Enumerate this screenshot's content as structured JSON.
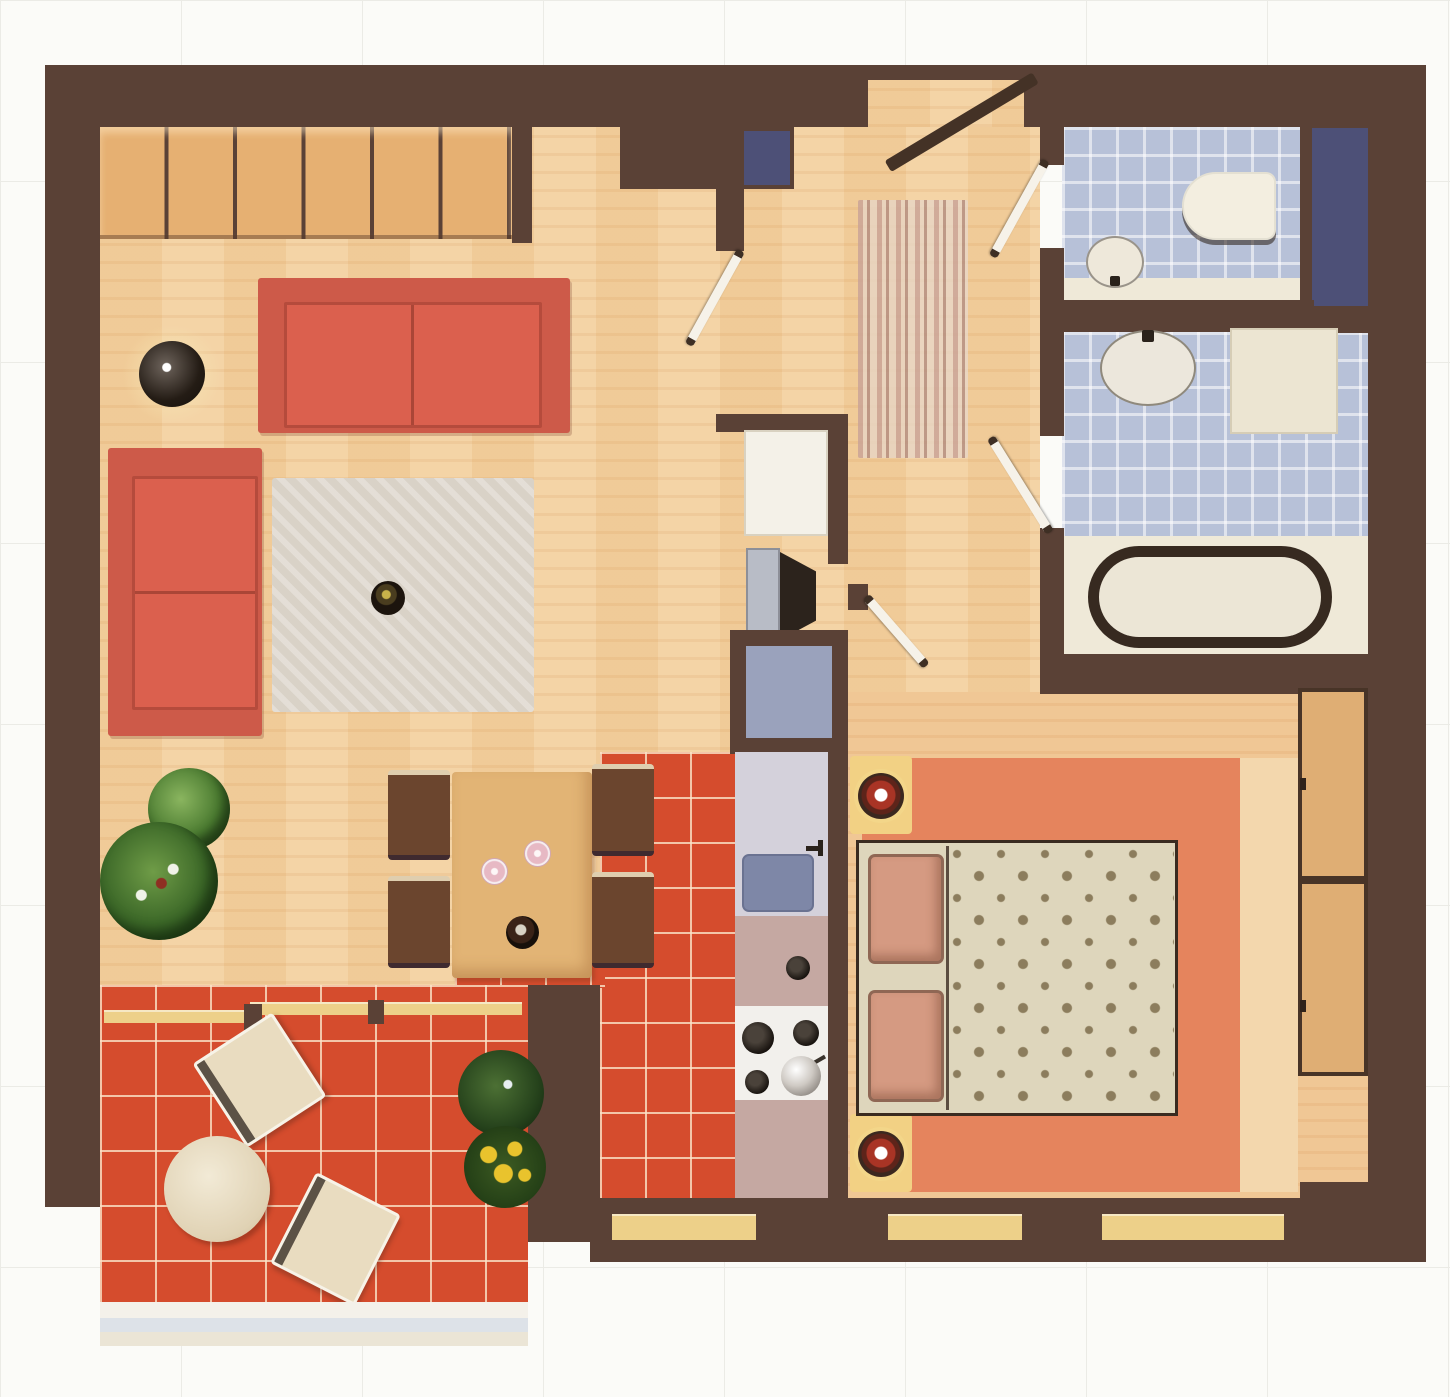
{
  "meta": {
    "kind": "apartment-floor-plan",
    "view": "top-down-3d-render",
    "text_labels": []
  },
  "palette": {
    "page_bg": "#fbfbf8",
    "grid_line": "#ebebe6",
    "wall": "#5a4136",
    "wood": "#f2cf9e",
    "wood_bedroom": "#f0c795",
    "closet": "#e6b072",
    "sofa_red": "#cd5a49",
    "rug_gray": "#d9d2c7",
    "tile_red": "#d54c2d",
    "blue_tile": "#b7c1d8",
    "navy": "#4d5077",
    "cream": "#efe9d8",
    "tub_line": "#372a20",
    "bedroom_rug": "#e5845d",
    "rug_border": "#f3d7ad",
    "bed_frame": "#f2d184",
    "lamp_red": "#a93425",
    "pillow": "#d59a82",
    "duvet": "#ded6bc",
    "duvet_dot": "#8c7d5d",
    "wardrobe": "#dfae74",
    "chair_brown": "#6b452e",
    "chair_cream": "#e9dcc0",
    "table_wood": "#e2b475",
    "counter": "#c5a8a2",
    "counter_light": "#d4d1db",
    "sink_blue": "#7e87a7",
    "cooktop": "#f2f0ec",
    "runner_a": "#c8a197",
    "runner_b": "#e7d5c5",
    "plant_green": "#49792f",
    "plant_dark": "#27491d",
    "flower_yellow": "#e9c32d",
    "door_white": "#f6f2e9",
    "door_dark": "#443226",
    "window_yellow": "#edd089",
    "tv_screen": "#b8bcc6",
    "niche_floor": "#9aa2bc"
  },
  "rooms": [
    {
      "id": "living-room",
      "floor": "light-wood"
    },
    {
      "id": "dining-area",
      "floor": "light-wood"
    },
    {
      "id": "kitchen",
      "floor": "red-tile"
    },
    {
      "id": "entrance-hall",
      "floor": "light-wood"
    },
    {
      "id": "wc",
      "floor": "blue-tile"
    },
    {
      "id": "bathroom",
      "floor": "blue-tile"
    },
    {
      "id": "bedroom",
      "floor": "wood-with-rug"
    },
    {
      "id": "terrace",
      "floor": "red-tile"
    }
  ],
  "furniture": {
    "living_room": [
      "wall-closet-6-doors",
      "three-seat-sofa",
      "two-seat-sofa",
      "globe-lamp-table",
      "area-rug",
      "decorative-bowl",
      "tv-unit",
      "white-cabinet",
      "storage-niche"
    ],
    "dining_area": [
      "wood-table",
      "chair-x4",
      "wine-glass-x2",
      "serving-bowl"
    ],
    "kitchen": [
      "counter-run",
      "sink",
      "faucet",
      "cooktop-4-burners",
      "pot",
      "control-knob"
    ],
    "entrance_hall": [
      "striped-runner-rug",
      "entry-door",
      "interior-door-x4",
      "wall-niche"
    ],
    "wc": [
      "toilet",
      "corner-washbasin",
      "navy-cabinet-niche"
    ],
    "bathroom": [
      "oval-washbasin",
      "side-cabinet",
      "bathtub"
    ],
    "bedroom": [
      "double-bed",
      "pillow-x2",
      "patterned-duvet",
      "bedside-table-x2",
      "red-lamp-x2",
      "salmon-rug",
      "built-in-wardrobe-2-doors",
      "window-band"
    ],
    "terrace": [
      "armchair-x2",
      "round-table",
      "potted-plant-x2",
      "flower-pot",
      "sliding-door",
      "railing"
    ]
  },
  "plants": [
    "bush-plant",
    "large-fern",
    "terrace-dark-plant",
    "yellow-flower-pot",
    "small-pot-on-table"
  ]
}
